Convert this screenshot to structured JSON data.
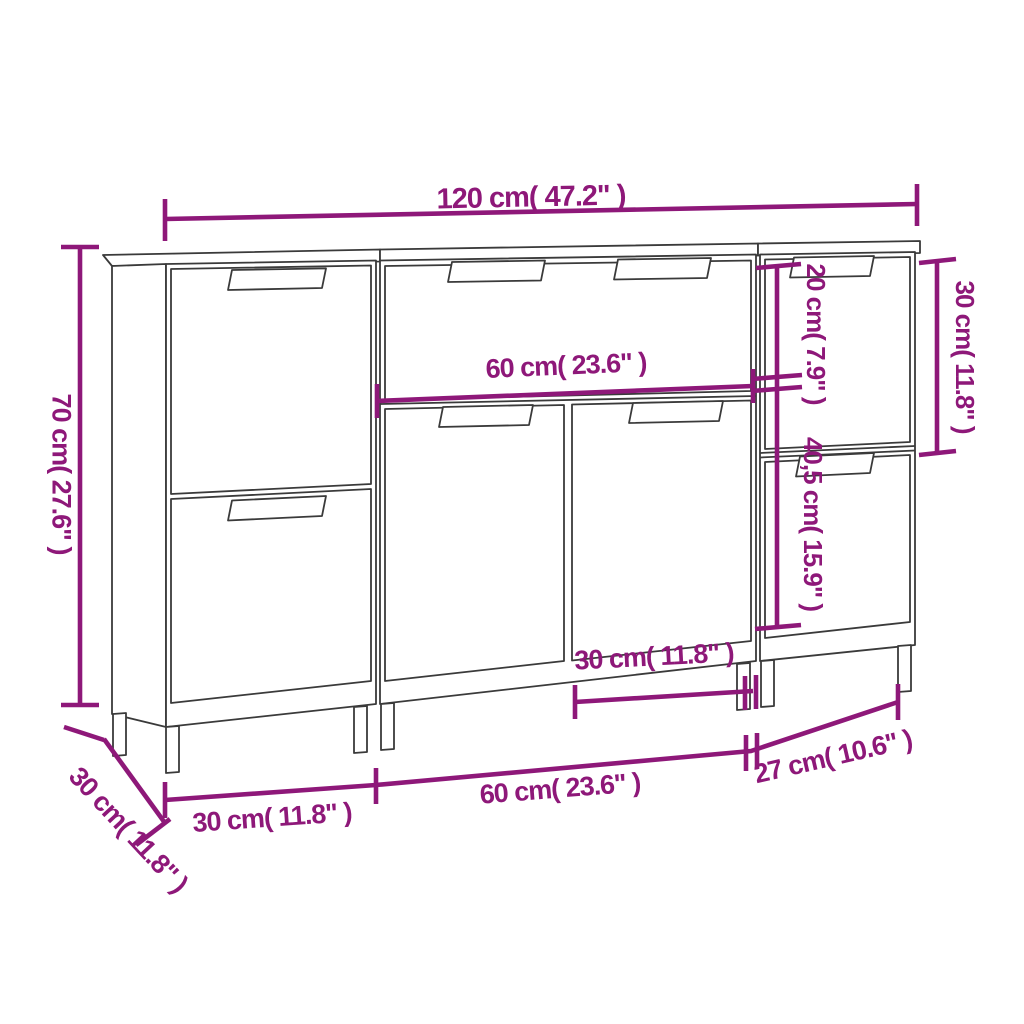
{
  "figure": {
    "type": "furniture-dimension-diagram",
    "subject": "three-piece sideboard set line drawing with dimension annotations"
  },
  "colors": {
    "dimension_accent": "#8E1879",
    "drawing_line": "#3A3A3A",
    "background": "#FFFFFF"
  },
  "dimensions": {
    "total_width": "120 cm( 47.2\" )",
    "height": "70 cm( 27.6\" )",
    "middle_top_width": "60 cm( 23.6\" )",
    "right_upper_door_height": "30 cm( 11.8\" )",
    "right_inner_upper": "20 cm( 7.9\" )",
    "right_inner_lower": "40,5 cm( 15.9\" )",
    "middle_door_width": "30 cm( 11.8\" )",
    "bottom_left_width": "30 cm( 11.8\" )",
    "bottom_middle_width": "60 cm( 23.6\" )",
    "bottom_right_width": "27 cm( 10.6\" )",
    "depth": "30 cm( 11.8\" )"
  }
}
